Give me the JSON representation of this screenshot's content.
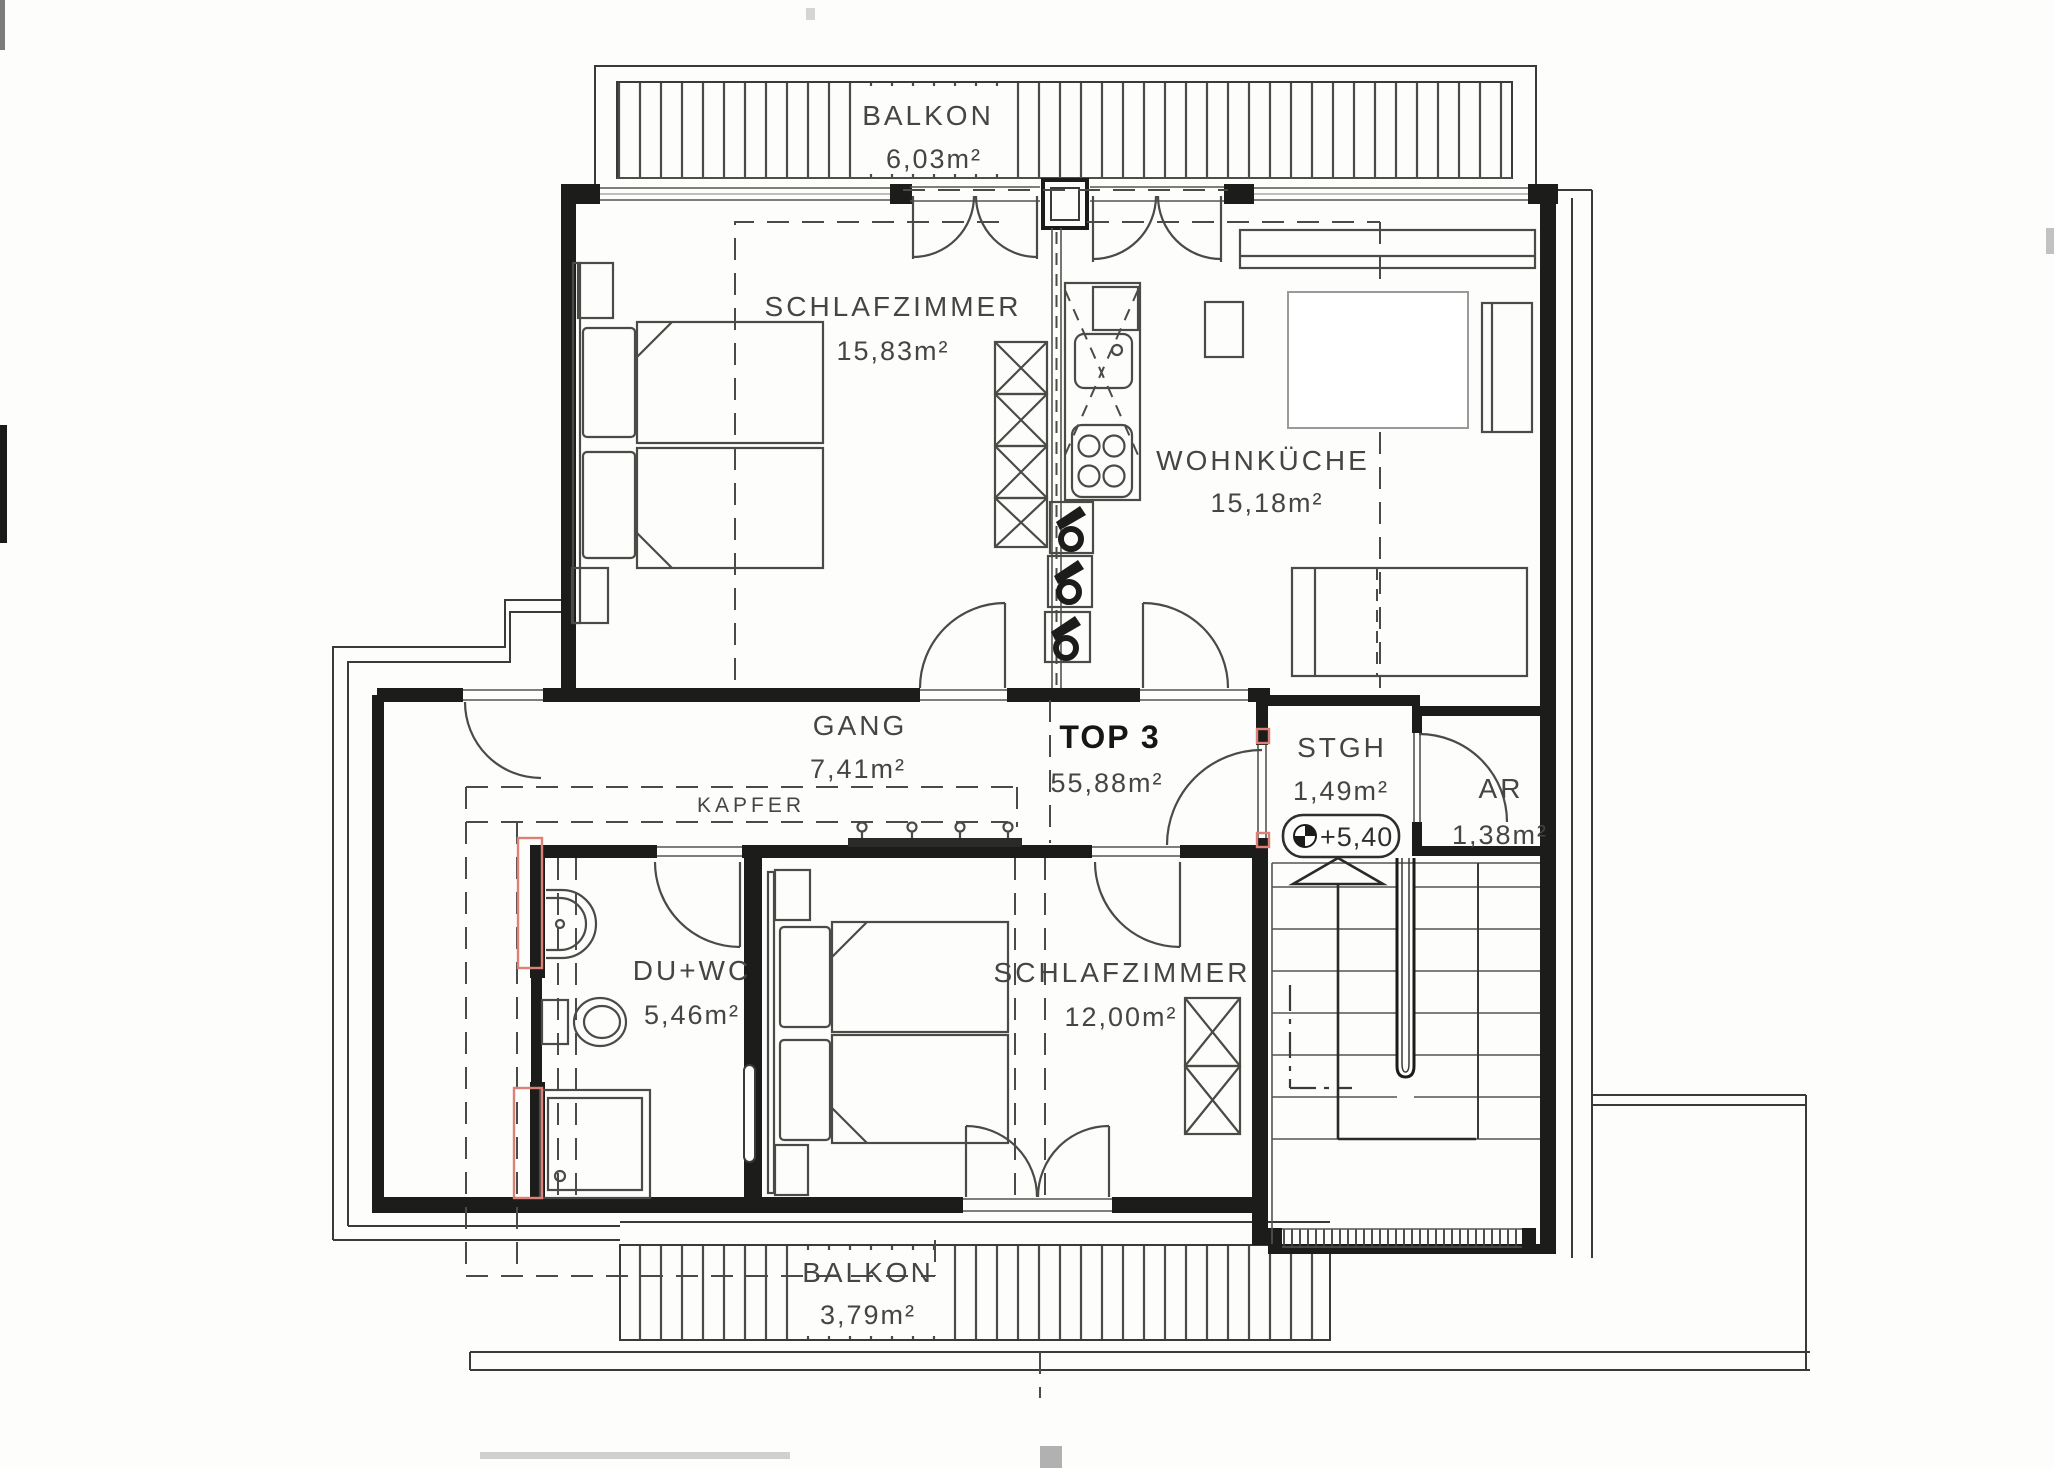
{
  "plan": {
    "unit_label": "TOP 3",
    "unit_area": "55,88m²",
    "rooms": [
      {
        "id": "balkon-top",
        "name": "BALKON",
        "area": "6,03m²"
      },
      {
        "id": "schlafzimmer-1",
        "name": "SCHLAFZIMMER",
        "area": "15,83m²"
      },
      {
        "id": "wohnkueche",
        "name": "WOHNKÜCHE",
        "area": "15,18m²"
      },
      {
        "id": "gang",
        "name": "GANG",
        "area": "7,41m²"
      },
      {
        "id": "stgh",
        "name": "STGH",
        "area": "1,49m²"
      },
      {
        "id": "ar",
        "name": "AR",
        "area": "1,38m²"
      },
      {
        "id": "du-wc",
        "name": "DU+WC",
        "area": "5,46m²"
      },
      {
        "id": "schlafzimmer-2",
        "name": "SCHLAFZIMMER",
        "area": "12,00m²"
      },
      {
        "id": "balkon-bottom",
        "name": "BALKON",
        "area": "3,79m²"
      }
    ],
    "annotations": {
      "kapfer_label": "KAPFER",
      "elevation_marker": "+5,40"
    },
    "colors": {
      "ink": "#1c1c1a",
      "line": "#3a3a38",
      "highlight_red": "#dd8077",
      "paper": "#fdfdfc"
    }
  }
}
